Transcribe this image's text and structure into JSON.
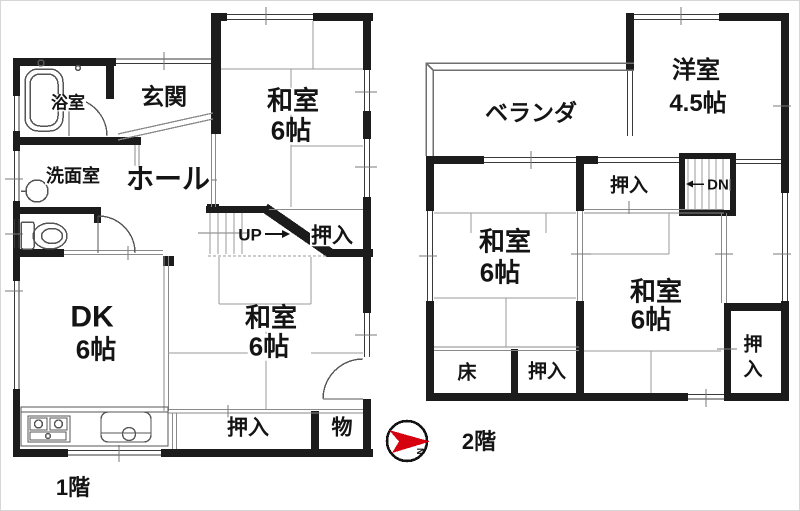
{
  "meta": {
    "floor1_label": "1階",
    "floor2_label": "2階",
    "compass_letter": "N"
  },
  "colors": {
    "wall": "#1c1c1c",
    "thin_line": "#8a8a8a",
    "fixture_line": "#555555",
    "compass_red": "#d7000f",
    "background": "#ffffff"
  },
  "floor1": {
    "bathroom": "浴室",
    "entrance": "玄関",
    "washitsu_ne_1": "和室",
    "washitsu_ne_2": "6帖",
    "washroom": "洗面室",
    "hall": "ホール",
    "stairs_up": "UP",
    "closet_by_stairs": "押入",
    "dk_1": "DK",
    "dk_2": "6帖",
    "washitsu_s_1": "和室",
    "washitsu_s_2": "6帖",
    "closet_s": "押入",
    "storage": "物"
  },
  "floor2": {
    "veranda": "ベランダ",
    "yoshitsu_1": "洋室",
    "yoshitsu_2": "4.5帖",
    "closet_n": "押入",
    "stairs_dn": "DN",
    "washitsu_w_1": "和室",
    "washitsu_w_2": "6帖",
    "washitsu_e_1": "和室",
    "washitsu_e_2": "6帖",
    "tokonoma": "床",
    "closet_mid": "押入",
    "closet_e_1": "押",
    "closet_e_2": "入"
  }
}
